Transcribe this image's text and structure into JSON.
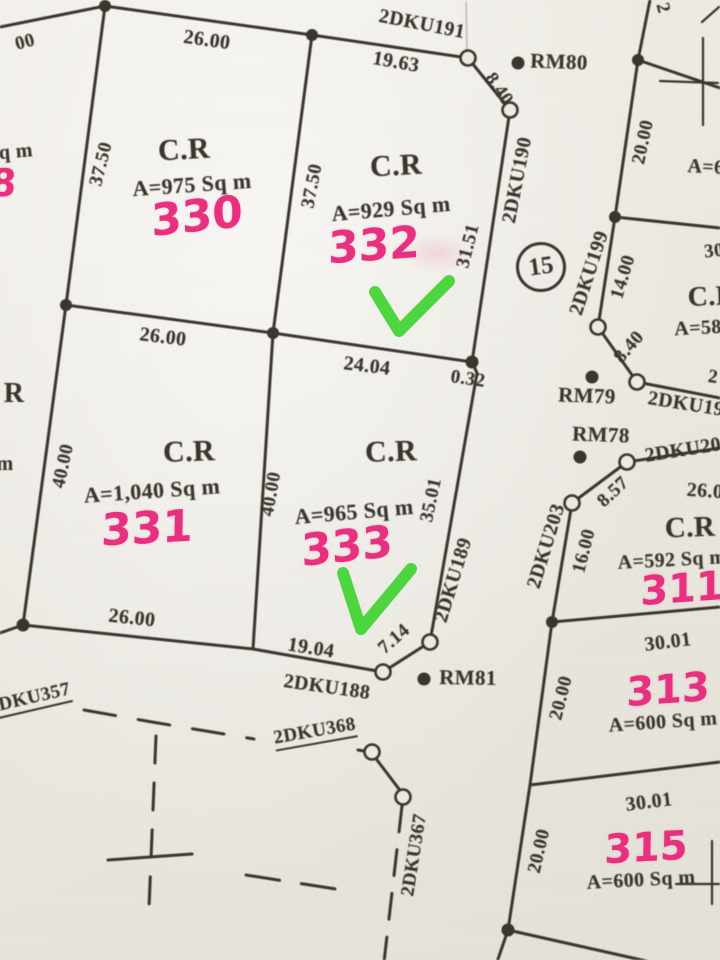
{
  "plots": {
    "p330": {
      "use": "C.R",
      "area": "A=975 Sq m",
      "number": "330",
      "side_top": "26.00",
      "side_left": "37.50",
      "side_bottom": "26.00"
    },
    "p332": {
      "use": "C.R",
      "area": "A=929 Sq m",
      "number": "332",
      "side_top": "19.63",
      "side_left": "37.50",
      "side_right": "31.51",
      "side_bottom": "24.04"
    },
    "p331": {
      "use": "C.R",
      "area": "A=1,040 Sq m",
      "number": "331",
      "side_left": "40.00",
      "side_bottom": "26.00"
    },
    "p333": {
      "use": "C.R",
      "area": "A=965 Sq m",
      "number": "333",
      "side_left": "40.00",
      "side_right": "35.01",
      "side_bottom": "19.04"
    },
    "p311": {
      "use": "C.R",
      "area": "A=592 Sq m",
      "number": "311",
      "side_top": "26.0",
      "side_left": "16.00"
    },
    "p313": {
      "number": "313",
      "area": "A=600 Sq m",
      "side_top": "30.01",
      "side_left": "20.00"
    },
    "p315": {
      "number": "315",
      "area": "A=600 Sq m",
      "side_top": "30.01",
      "side_left": "20.00"
    }
  },
  "block": {
    "number": "15"
  },
  "benchmarks": {
    "rm80": "RM80",
    "rm79": "RM79",
    "rm78": "RM78",
    "rm81": "RM81"
  },
  "survey_lines": {
    "dku191": "2DKU191",
    "dku190": "2DKU190",
    "dku199": "2DKU199",
    "dku189": "2DKU189",
    "dku188": "2DKU188",
    "dku203": "2DKU203",
    "dku19_partial": "2DKU19",
    "dku20_partial": "2DKU20",
    "dku357": "2DKU357",
    "dku368": "2DKU368",
    "dku367": "2DKU367"
  },
  "dimensions": {
    "seg_8_40_top": "8.40",
    "seg_8_40_right": "8.40",
    "seg_8_57": "8.57",
    "seg_7_14": "7.14",
    "seg_0_32": "0.32",
    "seg_20_00_right": "20.00",
    "seg_14_00": "14.00",
    "partial_00": "00"
  },
  "edge_partials": {
    "top_2": "2",
    "right_2": "2",
    "area_a6": "A=6",
    "use_cr": "C.R",
    "area_a58": "A=58",
    "dim_30": "30",
    "use_r": "R",
    "sq_m": "Sq m",
    "m": "m",
    "pink_8": "8"
  },
  "colors": {
    "ink": "#3b372f",
    "pink": "#e7307f",
    "green": "#3bd32c",
    "paper": "#ebe8e1"
  }
}
